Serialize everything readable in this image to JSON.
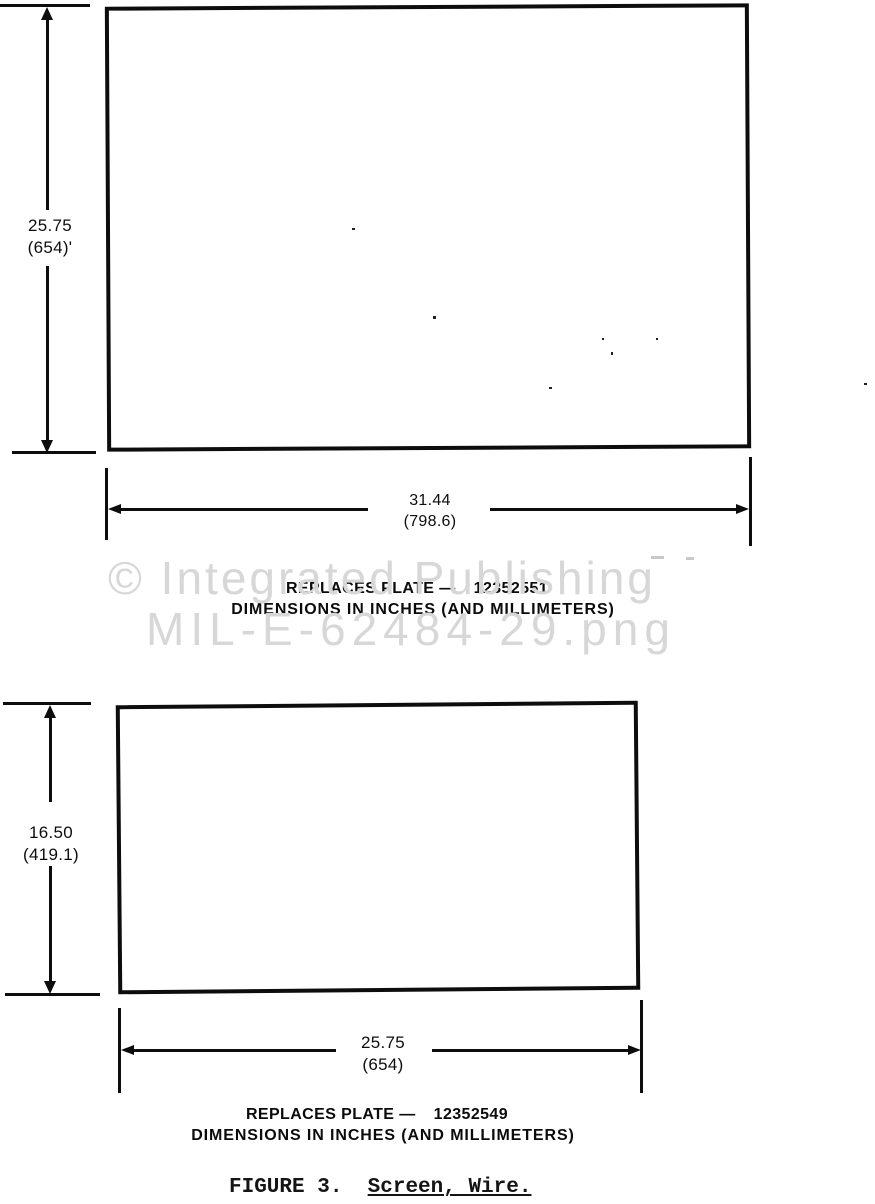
{
  "document": {
    "background": "#ffffff",
    "ink": "#0d0d0d"
  },
  "watermark": {
    "line1": "© Integrated Publishing",
    "line2": "MIL-E-62484-29.png",
    "color": "#d7d7d7"
  },
  "drawings": [
    {
      "height_dim": {
        "inches": "25.75",
        "mm": "(654)'"
      },
      "width_dim": {
        "inches": "31.44",
        "mm": "(798.6)"
      },
      "replaces_label": "REPLACES PLATE —",
      "plate_number": "12352551",
      "units_note": "DIMENSIONS IN INCHES (AND MILLIMETERS)"
    },
    {
      "height_dim": {
        "inches": "16.50",
        "mm": "(419.1)"
      },
      "width_dim": {
        "inches": "25.75",
        "mm": "(654)"
      },
      "replaces_label": "REPLACES PLATE —",
      "plate_number": "12352549",
      "units_note": "DIMENSIONS IN INCHES (AND MILLIMETERS)"
    }
  ],
  "caption": {
    "figure_label": "FIGURE 3.",
    "separator": "  ",
    "figure_title": "Screen, Wire."
  }
}
